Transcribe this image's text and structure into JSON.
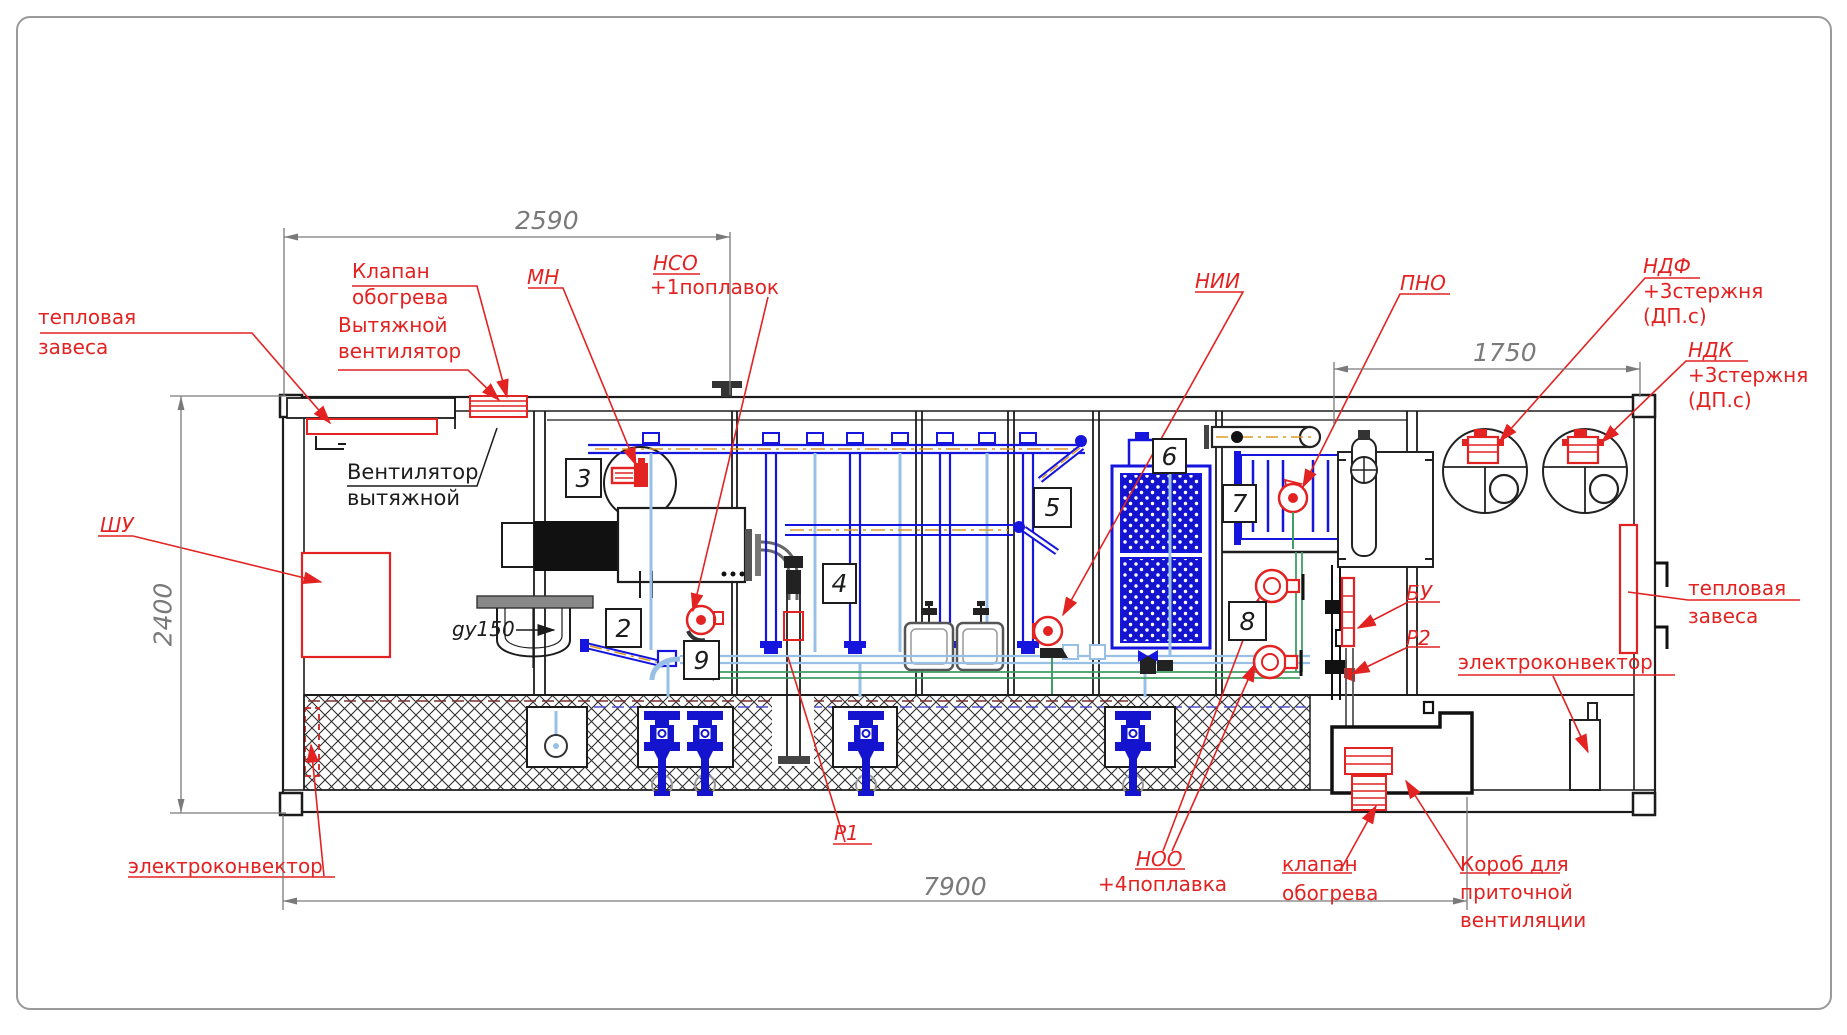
{
  "dims": {
    "top": "2590",
    "right": "1750",
    "left": "2400",
    "bottom": "7900"
  },
  "pos": {
    "n2": "2",
    "n3": "3",
    "n4": "4",
    "n5": "5",
    "n6": "6",
    "n7": "7",
    "n8": "8",
    "n9": "9"
  },
  "lbl": {
    "heat_left1": "тепловая",
    "heat_left2": "завеса",
    "klapan_top1": "Клапан",
    "klapan_top2": "обогрева",
    "exhaust1": "Вытяжной",
    "exhaust2": "вентилятор",
    "mn": "МН",
    "nso": "НСО",
    "nso2": "+1поплавок",
    "nii": "НИИ",
    "pno": "ПНО",
    "ndf": "НДФ",
    "ndf2": "+3стержня",
    "ndf3": "(ДП.с)",
    "ndk": "НДК",
    "ndk2": "+3стержня",
    "ndk3": "(ДП.с)",
    "fan1": "Вентилятор",
    "fan2": "вытяжной",
    "shu": "ШУ",
    "gy": "gy150",
    "bu": "БУ",
    "r2": "Р2",
    "r1": "Р1",
    "heat_right1": "тепловая",
    "heat_right2": "завеса",
    "electro": "электроконвектор",
    "noo": "НОО",
    "noo2": "+4поплавка",
    "klapan_bot1": "клапан",
    "klapan_bot2": "обогрева",
    "korob1": "Короб для",
    "korob2": "приточной",
    "korob3": "вентиляции"
  },
  "colors": {
    "red": "#e32222",
    "blue": "#1414cf",
    "lightblue": "#98c0e6",
    "orange": "#e09a28",
    "green": "#3f9e63",
    "dim_gray": "#7a7a7a",
    "ink": "#1c1c1c"
  }
}
